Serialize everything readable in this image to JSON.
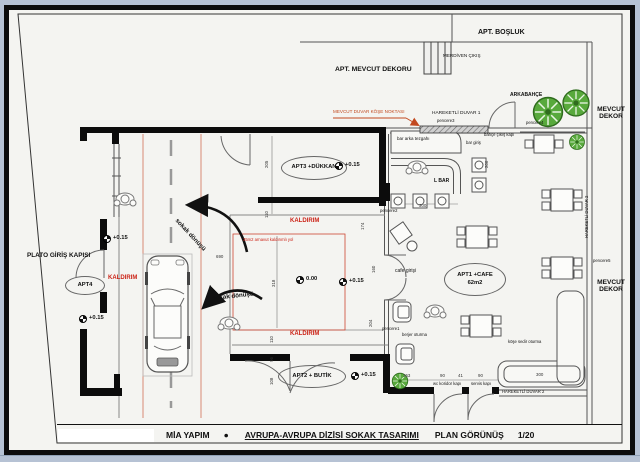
{
  "title_block": {
    "company": "MİA YAPIM",
    "separator": "●",
    "project": "AVRUPA-AVRUPA DİZİSİ SOKAK TASARIMI",
    "view": "PLAN GÖRÜNÜŞ",
    "scale": "1/20"
  },
  "areas": {
    "apt_bosluk": "APT. BOŞLUK",
    "apt_mevcut_dekoru": "APT. MEVCUT DEKORU",
    "merdiven_cikis": "MERDİVEN ÇIKIŞ",
    "arkabahce": "ARKABAHÇE",
    "mevcut_dekor": "MEVCUT\nDEKOR",
    "apt3": "APT3 +DÜKKAN",
    "apt4": "APT4",
    "apt2": "APT2 + BUTİK",
    "apt1_line1": "APT1 +CAFE",
    "apt1_line2": "62m2",
    "plato_giris": "PLATO GİRİŞ KAPISI"
  },
  "annotations": {
    "mevcut_duvar_kose": "MEVCUT DUVAR KÖŞE NOKTASI",
    "hareketli_duvar_1": "HAREKETLİ DUVAR 1",
    "hareketli_duvar_2": "HAREKETLİ DUVAR 2",
    "pencere1": "pencere1",
    "pencere2": "pencere2",
    "pencere3": "pencere3",
    "pencere4": "pencere4",
    "pencere5": "pencere5",
    "bar_arka_tezgahi": "bar arka tezgahı",
    "bar_giris": "bar giriş",
    "l_bar": "L BAR",
    "bahce_cikis_kapi": "bahçe çıkış kapı",
    "cafe_girisi": "cafe girişi",
    "berjer_oturma": "berjer oturma",
    "kose_sedir_oturma": "köşe sedir oturma",
    "wc_koridor_kapi": "wc koridor kapı",
    "servis_kapi": "servis kapı",
    "kaldirim": "KALDIRIM",
    "yol_notu": "35m2 arnavut kaldırımlı yol",
    "sokak_donusu": "sokak dönüşü"
  },
  "levels": {
    "plus015": "+0.15",
    "zero": "0.00"
  },
  "dims": {
    "d205": "205",
    "d110": "110",
    "d96": "96",
    "d108": "108",
    "d690": "690",
    "d318": "318",
    "d300": "300",
    "d206": "206",
    "d174": "174",
    "d160": "160",
    "d204": "204",
    "d153": "153",
    "d90": "90",
    "d41": "41"
  },
  "colors": {
    "kaldirim_red": "#cc2418",
    "annotation_orange": "#c2491f",
    "road_edge_red": "#d98a75",
    "tree_green": "#58a93c",
    "wall_black": "#0c0c0c"
  }
}
